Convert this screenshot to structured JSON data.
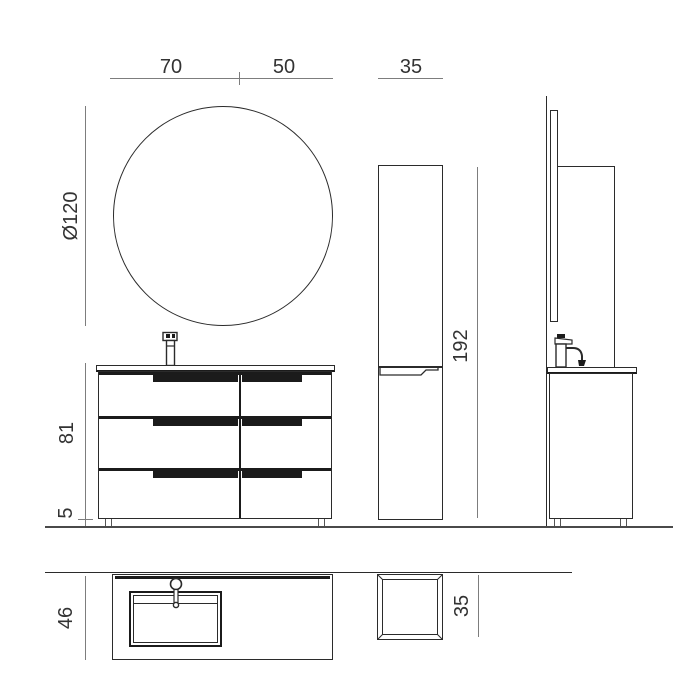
{
  "drawing": {
    "title": "Bathroom vanity technical drawing",
    "colors": {
      "furniture_line": "#2b2b2b",
      "handle_fill": "#1b1b1b",
      "dimension_line": "#7d7d7d",
      "label_text": "#333333",
      "background": "#ffffff"
    },
    "dimensions": {
      "vanity_width_left": "70",
      "vanity_width_right": "50",
      "column_width": "35",
      "mirror_diameter": "Ø120",
      "vanity_height": "81",
      "leg_height": "5",
      "column_height": "192",
      "vanity_depth": "46",
      "column_depth": "35"
    },
    "icons": {
      "faucet_front": "faucet-front-icon",
      "faucet_side": "faucet-side-icon",
      "faucet_top": "faucet-top-icon"
    }
  }
}
